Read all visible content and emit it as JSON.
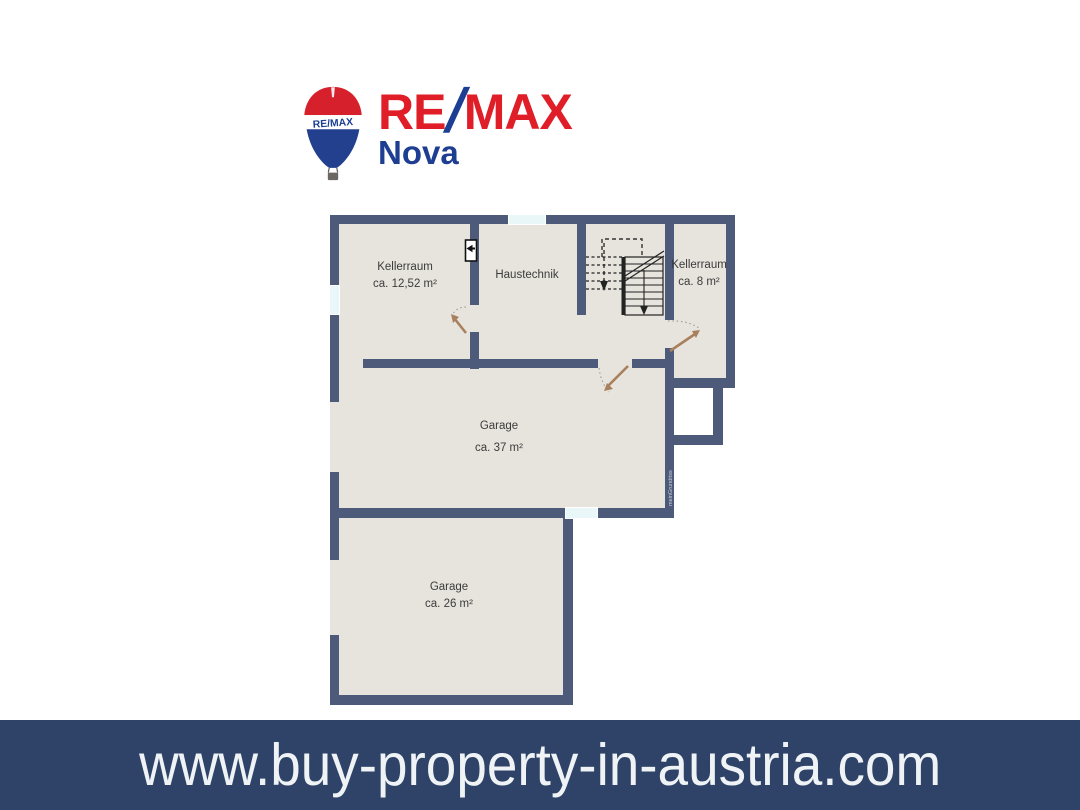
{
  "logo": {
    "brand_re": "RE",
    "brand_slash": "/",
    "brand_max": "MAX",
    "subbrand": "Nova",
    "balloon_text": "RE/MAX",
    "colors": {
      "red": "#e01e28",
      "blue": "#1c3f94"
    }
  },
  "floorplan": {
    "rooms": [
      {
        "id": "kellerraum-left",
        "name": "Kellerraum",
        "area": "ca. 12,52 m²"
      },
      {
        "id": "haustechnik",
        "name": "Haustechnik",
        "area": ""
      },
      {
        "id": "kellerraum-right",
        "name": "Kellerraum",
        "area": "ca. 8 m²"
      },
      {
        "id": "garage-large",
        "name": "Garage",
        "area": "ca. 37 m²"
      },
      {
        "id": "garage-small",
        "name": "Garage",
        "area": "ca. 26 m²"
      }
    ],
    "watermark": "meinGrundriss",
    "colors": {
      "wall": "#4e5a79",
      "floor": "#e7e4dd",
      "window": "#eaf7f8",
      "door_arrow": "#a9805e",
      "stairs": "#222222"
    }
  },
  "footer": {
    "url": "www.buy-property-in-austria.com",
    "background": "#2e4367",
    "text_color": "#eff3f6"
  }
}
